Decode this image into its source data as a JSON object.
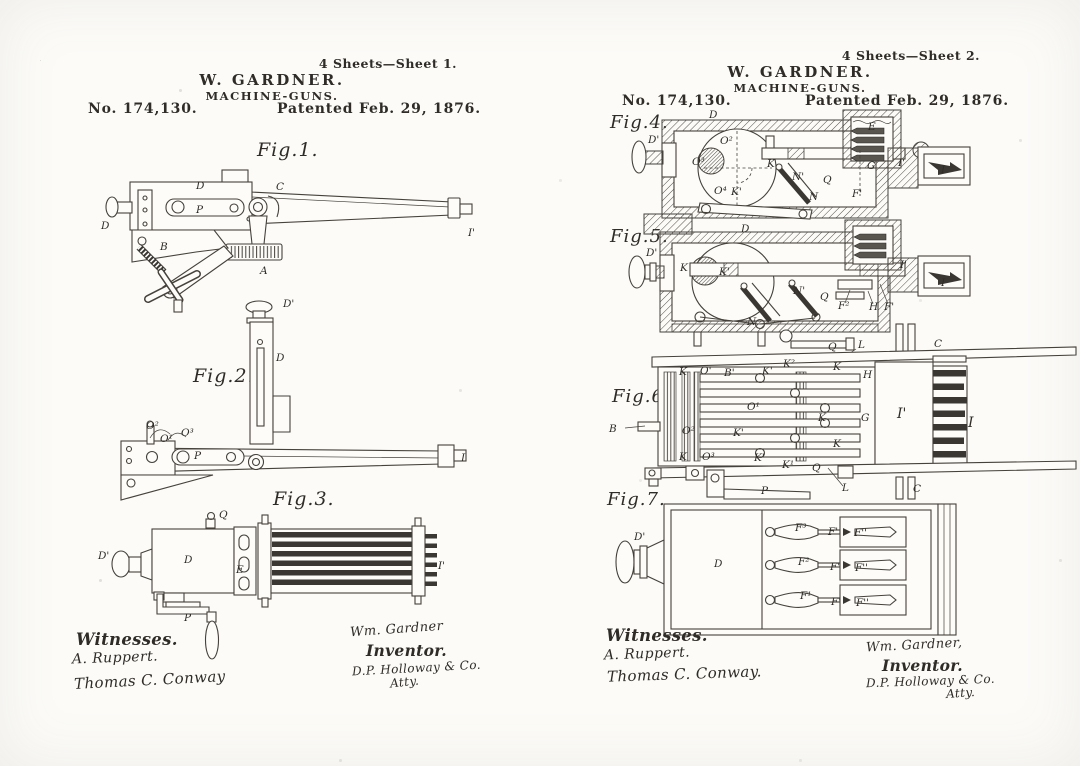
{
  "document": {
    "ink_color": "#2f2c28",
    "paper_color": "#fcfbf8"
  },
  "sheets": [
    {
      "sheet_note": "4 Sheets—Sheet 1.",
      "author_line": "W. GARDNER.",
      "title_line": "MACHINE-GUNS.",
      "patent_number": "No. 174,130.",
      "patent_date": "Patented Feb. 29, 1876.",
      "figures": [
        {
          "caption": "Fig.1.",
          "parts": [
            {
              "t": "D",
              "x": 196,
              "y": 189
            },
            {
              "t": "D",
              "x": 101,
              "y": 229
            },
            {
              "t": "P",
              "x": 196,
              "y": 213
            },
            {
              "t": "C",
              "x": 276,
              "y": 190
            },
            {
              "t": "B",
              "x": 160,
              "y": 250
            },
            {
              "t": "A",
              "x": 260,
              "y": 274
            },
            {
              "t": "I'",
              "x": 468,
              "y": 236
            }
          ]
        },
        {
          "caption": "Fig.2.",
          "parts": [
            {
              "t": "D'",
              "x": 283,
              "y": 307
            },
            {
              "t": "D",
              "x": 276,
              "y": 361
            },
            {
              "t": "O²",
              "x": 146,
              "y": 429
            },
            {
              "t": "O¹",
              "x": 160,
              "y": 442
            },
            {
              "t": "O³",
              "x": 181,
              "y": 436
            },
            {
              "t": "P",
              "x": 194,
              "y": 459
            },
            {
              "t": "I",
              "x": 461,
              "y": 461
            }
          ]
        },
        {
          "caption": "Fig.3.",
          "parts": [
            {
              "t": "D'",
              "x": 98,
              "y": 559
            },
            {
              "t": "Q",
              "x": 219,
              "y": 518
            },
            {
              "t": "D",
              "x": 184,
              "y": 563
            },
            {
              "t": "E",
              "x": 236,
              "y": 573
            },
            {
              "t": "P",
              "x": 184,
              "y": 621
            },
            {
              "t": "I'",
              "x": 438,
              "y": 569
            }
          ]
        }
      ],
      "signatures": {
        "witnesses_heading": "Witnesses.",
        "witness_1": "A. Ruppert.",
        "witness_2": "Thomas C. Conway",
        "inventor_signature": "Wm. Gardner",
        "inventor_heading": "Inventor.",
        "attorney_signature": "D.P. Holloway & Co.",
        "attorney_title": "Atty."
      }
    },
    {
      "sheet_note": "4 Sheets—Sheet 2.",
      "author_line": "W. GARDNER.",
      "title_line": "MACHINE-GUNS.",
      "patent_number": "No. 174,130.",
      "patent_date": "Patented Feb. 29, 1876.",
      "figures": [
        {
          "caption": "Fig.4.",
          "parts": [
            {
              "t": "D'",
              "x": 648,
              "y": 143
            },
            {
              "t": "D",
              "x": 709,
              "y": 118
            },
            {
              "t": "O²",
              "x": 720,
              "y": 144
            },
            {
              "t": "O³",
              "x": 692,
              "y": 165
            },
            {
              "t": "O⁴",
              "x": 714,
              "y": 194
            },
            {
              "t": "K'",
              "x": 731,
              "y": 195
            },
            {
              "t": "K",
              "x": 767,
              "y": 167
            },
            {
              "t": "N'",
              "x": 792,
              "y": 180
            },
            {
              "t": "N",
              "x": 809,
              "y": 200
            },
            {
              "t": "Q",
              "x": 823,
              "y": 183
            },
            {
              "t": "E",
              "x": 868,
              "y": 130
            },
            {
              "t": "G",
              "x": 867,
              "y": 169
            },
            {
              "t": "I'",
              "x": 898,
              "y": 166
            },
            {
              "t": "I",
              "x": 941,
              "y": 173
            },
            {
              "t": "F'",
              "x": 852,
              "y": 197
            }
          ]
        },
        {
          "caption": "Fig.5.",
          "parts": [
            {
              "t": "D'",
              "x": 646,
              "y": 256
            },
            {
              "t": "D",
              "x": 741,
              "y": 232
            },
            {
              "t": "K",
              "x": 680,
              "y": 271
            },
            {
              "t": "K'",
              "x": 719,
              "y": 275
            },
            {
              "t": "N'",
              "x": 793,
              "y": 294
            },
            {
              "t": "N",
              "x": 747,
              "y": 325
            },
            {
              "t": "Q",
              "x": 820,
              "y": 300
            },
            {
              "t": "F²",
              "x": 838,
              "y": 309
            },
            {
              "t": "H",
              "x": 869,
              "y": 310
            },
            {
              "t": "F'",
              "x": 884,
              "y": 310
            },
            {
              "t": "I'",
              "x": 900,
              "y": 268
            },
            {
              "t": "I",
              "x": 941,
              "y": 286
            }
          ]
        },
        {
          "caption": "Fig.6.",
          "parts": [
            {
              "t": "Q",
              "x": 828,
              "y": 350
            },
            {
              "t": "L",
              "x": 858,
              "y": 348
            },
            {
              "t": "C",
              "x": 934,
              "y": 347
            },
            {
              "t": "K",
              "x": 679,
              "y": 375
            },
            {
              "t": "O'",
              "x": 700,
              "y": 374
            },
            {
              "t": "B'",
              "x": 724,
              "y": 376
            },
            {
              "t": "K'",
              "x": 762,
              "y": 374
            },
            {
              "t": "K²",
              "x": 783,
              "y": 367
            },
            {
              "t": "K",
              "x": 833,
              "y": 370
            },
            {
              "t": "H",
              "x": 863,
              "y": 378
            },
            {
              "t": "O¹",
              "x": 747,
              "y": 410
            },
            {
              "t": "K",
              "x": 818,
              "y": 421
            },
            {
              "t": "G",
              "x": 861,
              "y": 421
            },
            {
              "t": "B",
              "x": 609,
              "y": 432
            },
            {
              "t": "O²",
              "x": 682,
              "y": 434
            },
            {
              "t": "K'",
              "x": 733,
              "y": 436
            },
            {
              "t": "K",
              "x": 679,
              "y": 460
            },
            {
              "t": "O³",
              "x": 702,
              "y": 460
            },
            {
              "t": "K'",
              "x": 754,
              "y": 461
            },
            {
              "t": "K¹",
              "x": 782,
              "y": 468
            },
            {
              "t": "K",
              "x": 833,
              "y": 447
            },
            {
              "t": "Q",
              "x": 812,
              "y": 471
            },
            {
              "t": "P",
              "x": 761,
              "y": 494
            },
            {
              "t": "L",
              "x": 842,
              "y": 491
            },
            {
              "t": "C",
              "x": 913,
              "y": 492
            },
            {
              "t": "I'",
              "x": 897,
              "y": 418,
              "s": 14
            },
            {
              "t": "I",
              "x": 968,
              "y": 427,
              "s": 14
            }
          ]
        },
        {
          "caption": "Fig.7.",
          "parts": [
            {
              "t": "D'",
              "x": 634,
              "y": 540
            },
            {
              "t": "D",
              "x": 714,
              "y": 567
            },
            {
              "t": "F³",
              "x": 795,
              "y": 531
            },
            {
              "t": "F²",
              "x": 798,
              "y": 565
            },
            {
              "t": "F¹",
              "x": 800,
              "y": 599
            },
            {
              "t": "F'",
              "x": 828,
              "y": 535
            },
            {
              "t": "F''",
              "x": 854,
              "y": 536
            },
            {
              "t": "F'",
              "x": 830,
              "y": 570
            },
            {
              "t": "F''",
              "x": 855,
              "y": 571
            },
            {
              "t": "F'",
              "x": 831,
              "y": 605
            },
            {
              "t": "F''",
              "x": 856,
              "y": 606
            }
          ]
        }
      ],
      "signatures": {
        "witnesses_heading": "Witnesses.",
        "witness_1": "A. Ruppert.",
        "witness_2": "Thomas C. Conway.",
        "inventor_signature": "Wm. Gardner,",
        "inventor_heading": "Inventor.",
        "attorney_signature": "D.P. Holloway & Co.",
        "attorney_title": "Atty."
      }
    }
  ]
}
